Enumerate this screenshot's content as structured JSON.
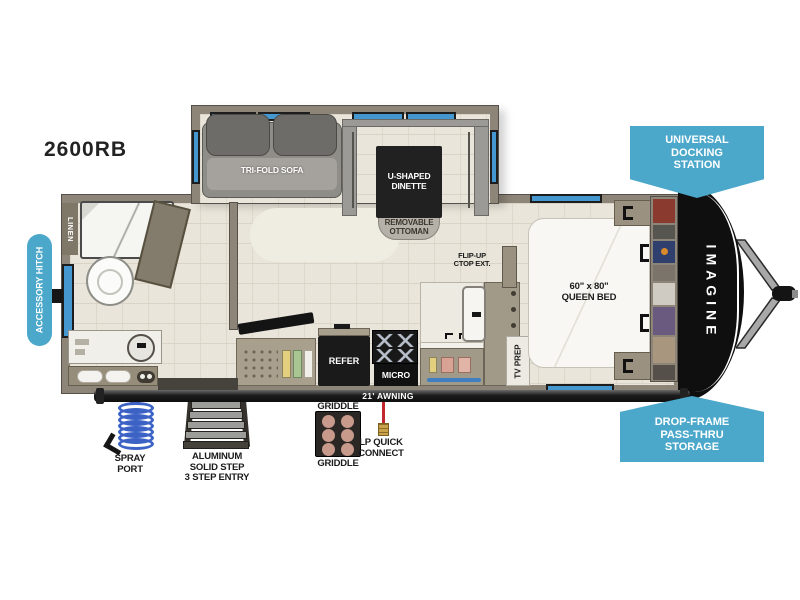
{
  "title": {
    "model": "2600RB"
  },
  "badges": {
    "accessory_hitch": {
      "text": "ACCESSORY HITCH"
    },
    "universal_docking": {
      "lines": [
        "UNIVERSAL",
        "DOCKING",
        "STATION"
      ]
    },
    "drop_frame_storage": {
      "lines": [
        "DROP-FRAME",
        "PASS-THRU",
        "STORAGE"
      ]
    }
  },
  "interior": {
    "bathroom": {
      "linen": "LINEN"
    },
    "living": {
      "sofa": "TRI-FOLD SOFA",
      "dinette": [
        "U-SHAPED",
        "DINETTE"
      ],
      "ottoman": [
        "REMOVABLE",
        "OTTOMAN"
      ]
    },
    "kitchen": {
      "refer": "REFER",
      "micro": "MICRO",
      "flip_up_ctop": [
        "FLIP-UP",
        "CTOP EXT."
      ]
    },
    "bedroom": {
      "bed": [
        "60\" x 80\"",
        "QUEEN BED"
      ],
      "tv_prep": "TV PREP"
    }
  },
  "exterior": {
    "brand": "IMAGINE",
    "awning": "21' AWNING",
    "spray_port": [
      "SPRAY",
      "PORT"
    ],
    "entry_steps": [
      "ALUMINUM",
      "SOLID STEP",
      "3 STEP ENTRY"
    ],
    "griddle_label_top": "GRIDDLE",
    "griddle_label_bottom": "GRIDDLE",
    "lp_quick_connect": [
      "LP QUICK",
      "CONNECT"
    ]
  },
  "colors": {
    "badge_blue": "#4BA8CA",
    "window_blue": "#4497CF",
    "wall_taupe": "#8D8577",
    "floor_beige": "#E9E5DA",
    "cap_black": "#0F0F0F",
    "lp_red": "#C1272D",
    "spray_coil_blue": "#3B62C4"
  }
}
